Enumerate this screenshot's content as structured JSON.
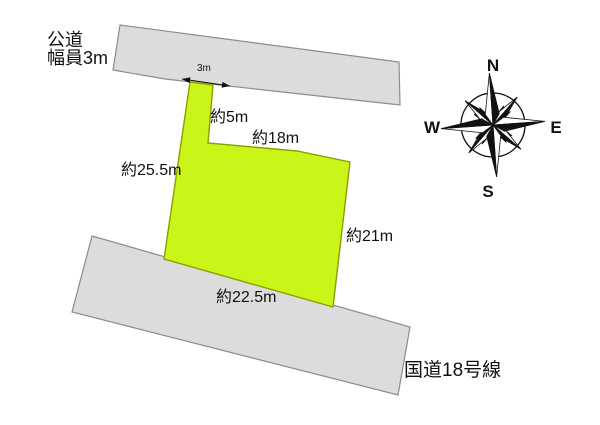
{
  "diagram": {
    "top_road": {
      "label_line1": "公道",
      "label_line2": "幅員3m"
    },
    "bottom_road": {
      "label": "国道18号線"
    },
    "parcel": {
      "frontage_width": "3m",
      "side_pole": "約5m",
      "side_top": "約18m",
      "side_west": "約25.5m",
      "side_east": "約21m",
      "side_south": "約22.5m"
    },
    "compass": {
      "north": "N",
      "east": "E",
      "south": "S",
      "west": "W"
    },
    "colors": {
      "parcel_fill": "#c9f518",
      "parcel_stroke": "#8aa000",
      "road_fill": "#dcdcdc",
      "road_stroke": "#8c8c8c",
      "text": "#111111"
    }
  }
}
